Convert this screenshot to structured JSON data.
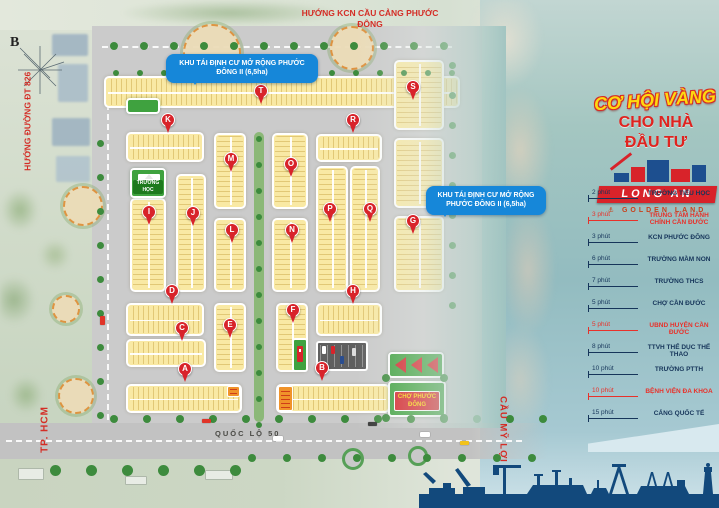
{
  "compass": {
    "north_label": "B"
  },
  "headings": {
    "top_direction": "HƯỚNG KCN CẦU CẢNG PHƯỚC ĐÔNG",
    "left_direction": "HƯỚNG ĐƯỜNG ĐT 826",
    "tphcm": "TP. HCM",
    "cau_my_loi": "CẦU MỸ LỢI",
    "highway": "QUỐC LỘ 50"
  },
  "callouts": {
    "resettlement_1": "KHU TÁI ĐỊNH CƯ MỞ RỘNG PHƯỚC ĐÔNG II (6,5ha)",
    "resettlement_2": "KHU TÁI ĐỊNH CƯ MỞ RỘNG PHƯỚC ĐÔNG II (6,5ha)"
  },
  "promo": {
    "headline_1": "CƠ HỘI VÀNG",
    "headline_2": "CHO NHÀ",
    "headline_3": "ĐẦU TƯ",
    "brand": "LONG AN",
    "brand_sub": "⚓ GOLDEN LAND"
  },
  "map_labels": {
    "school": "TRƯỜNG HỌC",
    "market": "CHỢ PHƯỚC ĐÔNG"
  },
  "pins": {
    "a": "A",
    "b": "B",
    "c": "C",
    "d": "D",
    "e": "E",
    "f": "F",
    "g": "G",
    "h": "H",
    "i": "I",
    "j": "J",
    "k": "K",
    "l": "L",
    "m": "M",
    "n": "N",
    "o": "O",
    "p": "P",
    "q": "Q",
    "r": "R",
    "s": "S",
    "t": "T"
  },
  "poi_list": [
    {
      "time": "2 phút",
      "name": "TRƯỜNG TIỂU HỌC"
    },
    {
      "time": "3 phút",
      "name": "TRUNG TÂM HÀNH CHÍNH CẦN ĐƯỚC"
    },
    {
      "time": "3 phút",
      "name": "KCN PHƯỚC ĐÔNG"
    },
    {
      "time": "6 phút",
      "name": "TRƯỜNG MẦM NON"
    },
    {
      "time": "7 phút",
      "name": "TRƯỜNG THCS"
    },
    {
      "time": "5 phút",
      "name": "CHỢ CẦN ĐƯỚC"
    },
    {
      "time": "5 phút",
      "name": "UBND HUYỆN CẦN ĐƯỚC"
    },
    {
      "time": "8 phút",
      "name": "TTVH THỂ DỤC THỂ THAO"
    },
    {
      "time": "10 phút",
      "name": "TRƯỜNG PTTH"
    },
    {
      "time": "10 phút",
      "name": "BỆNH VIỆN ĐA KHOA"
    },
    {
      "time": "15 phút",
      "name": "CẢNG QUỐC TẾ"
    }
  ]
}
